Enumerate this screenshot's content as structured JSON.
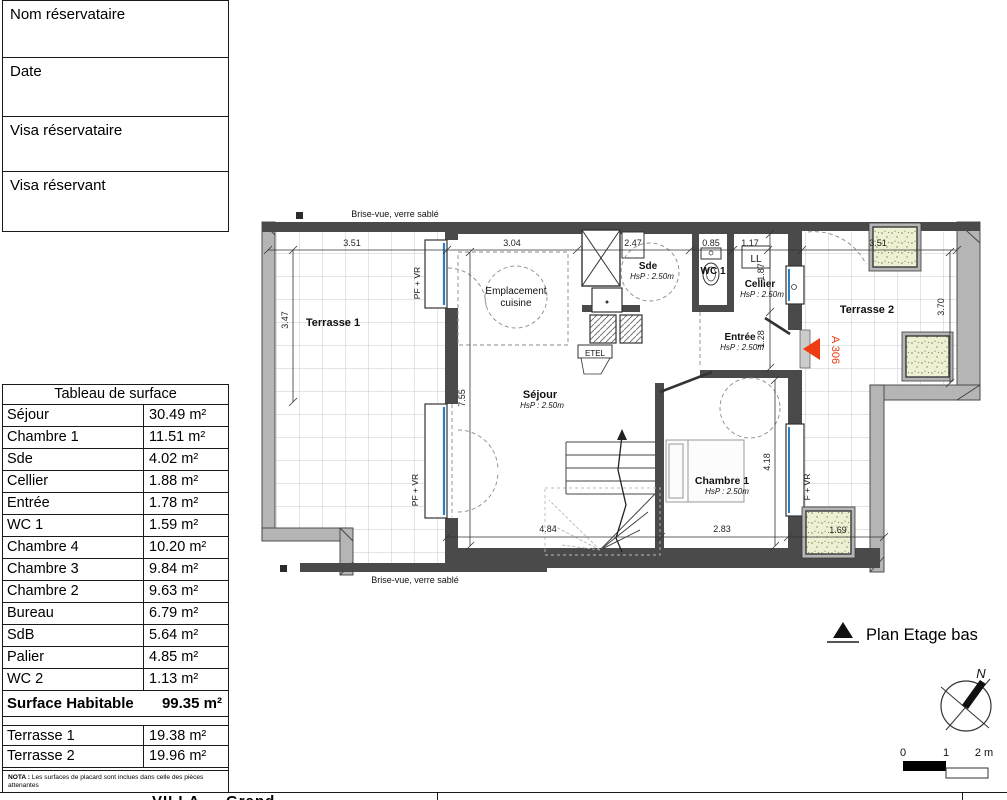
{
  "form": {
    "fields": [
      {
        "label": "Nom réservataire"
      },
      {
        "label": "Date"
      },
      {
        "label": "Visa réservataire"
      },
      {
        "label": "Visa réservant"
      }
    ]
  },
  "table": {
    "title": "Tableau de surface",
    "rows": [
      {
        "label": "Séjour",
        "value": "30.49 m²"
      },
      {
        "label": "Chambre 1",
        "value": "11.51 m²"
      },
      {
        "label": "Sde",
        "value": "4.02 m²"
      },
      {
        "label": "Cellier",
        "value": "1.88 m²"
      },
      {
        "label": "Entrée",
        "value": "1.78 m²"
      },
      {
        "label": "WC 1",
        "value": "1.59 m²"
      },
      {
        "label": "Chambre 4",
        "value": "10.20 m²"
      },
      {
        "label": "Chambre 3",
        "value": "9.84 m²"
      },
      {
        "label": "Chambre 2",
        "value": "9.63 m²"
      },
      {
        "label": "Bureau",
        "value": "6.79 m²"
      },
      {
        "label": "SdB",
        "value": "5.64 m²"
      },
      {
        "label": "Palier",
        "value": "4.85 m²"
      },
      {
        "label": "WC 2",
        "value": "1.13 m²"
      }
    ],
    "total": {
      "label": "Surface Habitable",
      "value": "99.35 m²"
    },
    "terraces": [
      {
        "label": "Terrasse 1",
        "value": "19.38 m²"
      },
      {
        "label": "Terrasse 2",
        "value": "19.96 m²"
      }
    ],
    "nota_bold": "NOTA :",
    "nota_text": " Les surfaces de placard sont inclues dans celle des pièces attenantes"
  },
  "plan": {
    "brise_vue": "Brise-vue, verre sablé",
    "rooms": {
      "terrasse1": "Terrasse 1",
      "terrasse2": "Terrasse 2",
      "sejour": "Séjour",
      "sde": "Sde",
      "wc1": "WC 1",
      "cellier": "Cellier",
      "entree": "Entrée",
      "chambre1": "Chambre 1",
      "ll": "LL",
      "etel": "ETEL",
      "emplacement_line1": "Emplacement",
      "emplacement_line2": "cuisine"
    },
    "hsp": "HsP : 2.50m",
    "window_labels": {
      "pf_vr": "PF + VR",
      "f_vr": "F + VR"
    },
    "unit_marker": "A 306",
    "dims": {
      "t1_w": "3.51",
      "sej_w": "3.04",
      "sde_w": "2.47",
      "wc_w": "0.85",
      "ll_w": "1.17",
      "t2_w": "3.51",
      "t1_h": "3.47",
      "sej_h": "7.55",
      "bot1": "4.84",
      "bot2": "2.83",
      "ch1_h": "4.18",
      "t2_h": "3.70",
      "cel_h": "1.87",
      "ent_h": "1.28",
      "planter_w": "1.69"
    }
  },
  "legend": {
    "title": "Plan Etage bas",
    "north": "N",
    "scale_0": "0",
    "scale_1": "1",
    "scale_2": "2 m"
  },
  "footer": {
    "partial_title": "VILLA … Grand …"
  },
  "colors": {
    "marker_red": "#ee3b12",
    "planter_fill": "#edf0d2",
    "wall_dark": "#4a4a4a",
    "parapet_gray": "#b5b5b5",
    "glazing_blue": "#2b7cc0"
  }
}
